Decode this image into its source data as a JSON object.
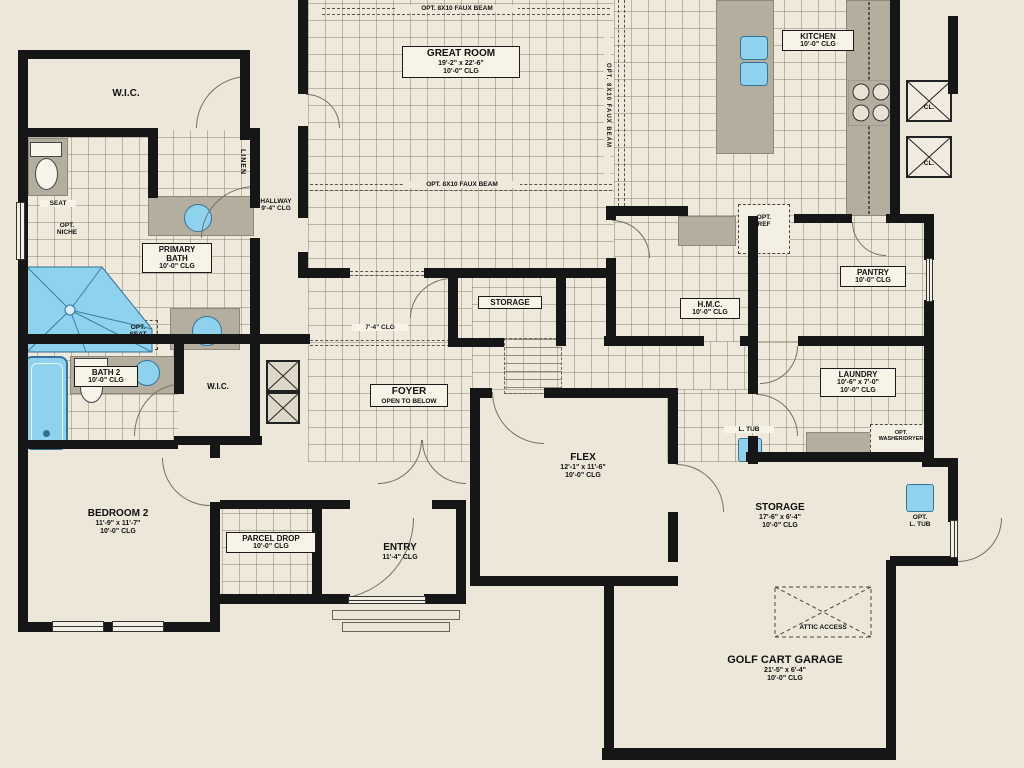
{
  "rooms": {
    "great_room": {
      "lines": [
        "GREAT ROOM",
        "19'-2\" x 22'-6\"",
        "10'-0\" CLG"
      ]
    },
    "kitchen": {
      "lines": [
        "KITCHEN",
        "10'-0\" CLG"
      ]
    },
    "pantry": {
      "lines": [
        "PANTRY",
        "10'-0\" CLG"
      ]
    },
    "hmc": {
      "lines": [
        "H.M.C.",
        "10'-0\" CLG"
      ]
    },
    "hallway": {
      "lines": [
        "HALLWAY",
        "9'-4\" CLG"
      ]
    },
    "wic1": {
      "lines": [
        "W.I.C."
      ]
    },
    "wic2": {
      "lines": [
        "W.I.C."
      ]
    },
    "primary_bath": {
      "lines": [
        "PRIMARY",
        "BATH",
        "10'-0\" CLG"
      ]
    },
    "bath2": {
      "lines": [
        "BATH 2",
        "10'-0\" CLG"
      ]
    },
    "storage_hall": {
      "lines": [
        "STORAGE"
      ]
    },
    "laundry": {
      "lines": [
        "LAUNDRY",
        "10'-6\" x 7'-0\"",
        "10'-0\" CLG"
      ]
    },
    "foyer": {
      "lines": [
        "FOYER",
        "OPEN TO BELOW"
      ]
    },
    "flex": {
      "lines": [
        "FLEX",
        "12'-1\" x 11'-6\"",
        "10'-0\" CLG"
      ]
    },
    "storage_garage": {
      "lines": [
        "STORAGE",
        "17'-6\" x 6'-4\"",
        "10'-0\" CLG"
      ]
    },
    "golf_cart_garage": {
      "lines": [
        "GOLF CART GARAGE",
        "21'-5\" x 6'-4\"",
        "10'-0\" CLG"
      ]
    },
    "bedroom2": {
      "lines": [
        "BEDROOM 2",
        "11'-9\" x 11'-7\"",
        "10'-0\" CLG"
      ]
    },
    "parcel_drop": {
      "lines": [
        "PARCEL DROP",
        "10'-0\" CLG"
      ]
    },
    "entry": {
      "lines": [
        "ENTRY",
        "11'-4\" CLG"
      ]
    }
  },
  "annotations": {
    "faux_beam_top": "OPT. 8X10 FAUX BEAM",
    "faux_beam_mid": "OPT. 8X10 FAUX BEAM",
    "faux_beam_side": "OPT. 8X10 FAUX BEAM",
    "hall_clg": "7'-4\" CLG",
    "seat": "SEAT",
    "opt_niche": [
      "OPT.",
      "NICHE"
    ],
    "opt_seat": [
      "OPT.",
      "SEAT"
    ],
    "linen": "LINEN",
    "opt_ref": [
      "OPT.",
      "REF"
    ],
    "opt_washer_dryer": [
      "OPT.",
      "WASHER/DRYER"
    ],
    "laundry_tub": "L. TUB",
    "opt_laundry_tub": [
      "OPT.",
      "L. TUB"
    ],
    "attic_access": "ATTIC ACCESS",
    "closet_chase": "CL."
  },
  "colors": {
    "paper": "#ece7d9",
    "wall": "#161616",
    "tile_bg": "#eee9da",
    "grid_line": "#7d7662",
    "counter": "#b4ae9f",
    "fixture_blue": "#8ed2ee",
    "label_bg": "#f7f3e7"
  }
}
